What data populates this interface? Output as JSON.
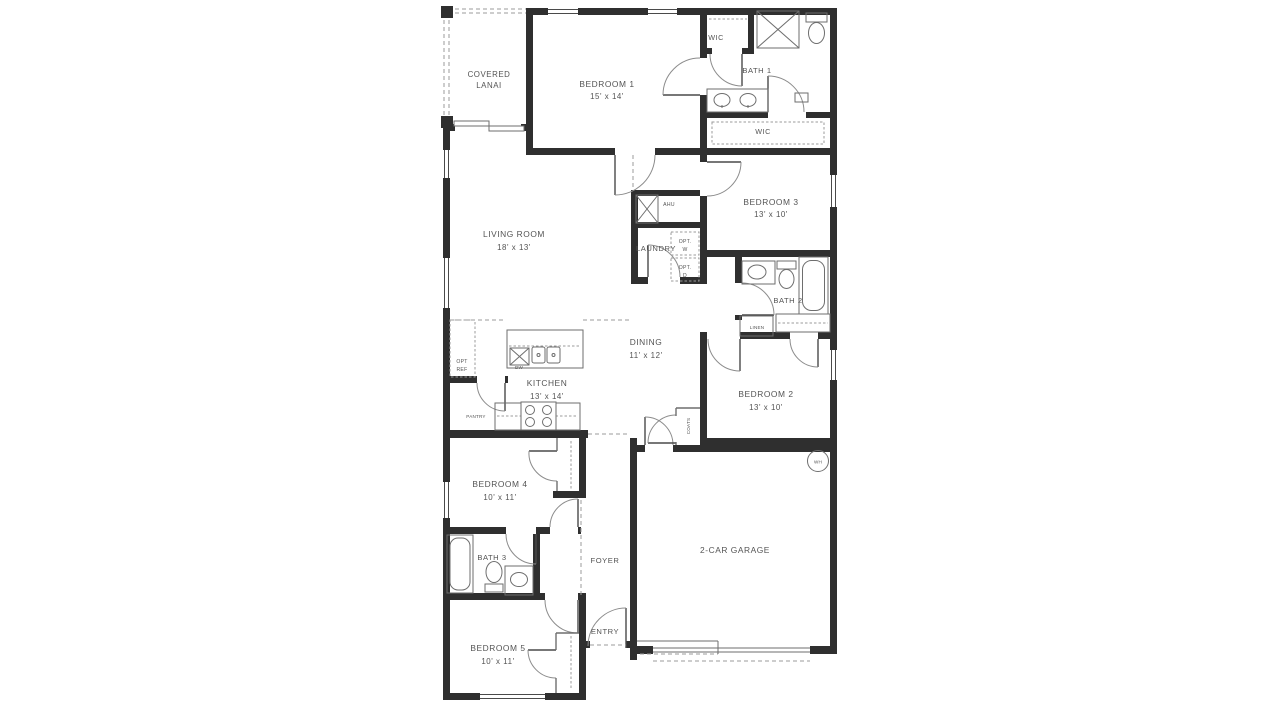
{
  "colors": {
    "bg": "#ffffff",
    "wall": "#2f2f2f",
    "line": "#6e6e6e",
    "dash": "#9b9b9b",
    "text": "#545454"
  },
  "rooms": {
    "lanai": {
      "line1": "COVERED",
      "line2": "LANAI"
    },
    "bedroom1": {
      "name": "BEDROOM 1",
      "dims": "15' x 14'"
    },
    "wic_upper": {
      "name": "WIC"
    },
    "bath1": {
      "name": "BATH 1"
    },
    "wic_main": {
      "name": "WIC"
    },
    "bedroom3": {
      "name": "BEDROOM 3",
      "dims": "13' x 10'"
    },
    "living_room": {
      "name": "LIVING ROOM",
      "dims": "18' x 13'"
    },
    "laundry": {
      "name": "LAUNDRY"
    },
    "bath2": {
      "name": "BATH 2"
    },
    "dining": {
      "name": "DINING",
      "dims": "11' x 12'"
    },
    "kitchen": {
      "name": "KITCHEN",
      "dims": "13' x 14'"
    },
    "bedroom2": {
      "name": "BEDROOM 2",
      "dims": "13' x 10'"
    },
    "garage": {
      "name": "2-CAR GARAGE"
    },
    "bedroom4": {
      "name": "BEDROOM 4",
      "dims": "10' x 11'"
    },
    "bath3": {
      "name": "BATH 3"
    },
    "foyer": {
      "name": "FOYER"
    },
    "entry": {
      "name": "ENTRY"
    },
    "bedroom5": {
      "name": "BEDROOM 5",
      "dims": "10' x 11'"
    }
  },
  "closets": {
    "linen": "LINEN",
    "coats": "COATS",
    "pantry": "PANTRY"
  },
  "equipment": {
    "ahu": "AHU",
    "water_heater": "WH",
    "dishwasher": "DW",
    "opt_washer_l1": "OPT.",
    "opt_washer_l2": "W",
    "opt_dryer_l1": "OPT.",
    "opt_dryer_l2": "D",
    "opt_fridge_l1": "OPT",
    "opt_fridge_l2": "REF"
  }
}
